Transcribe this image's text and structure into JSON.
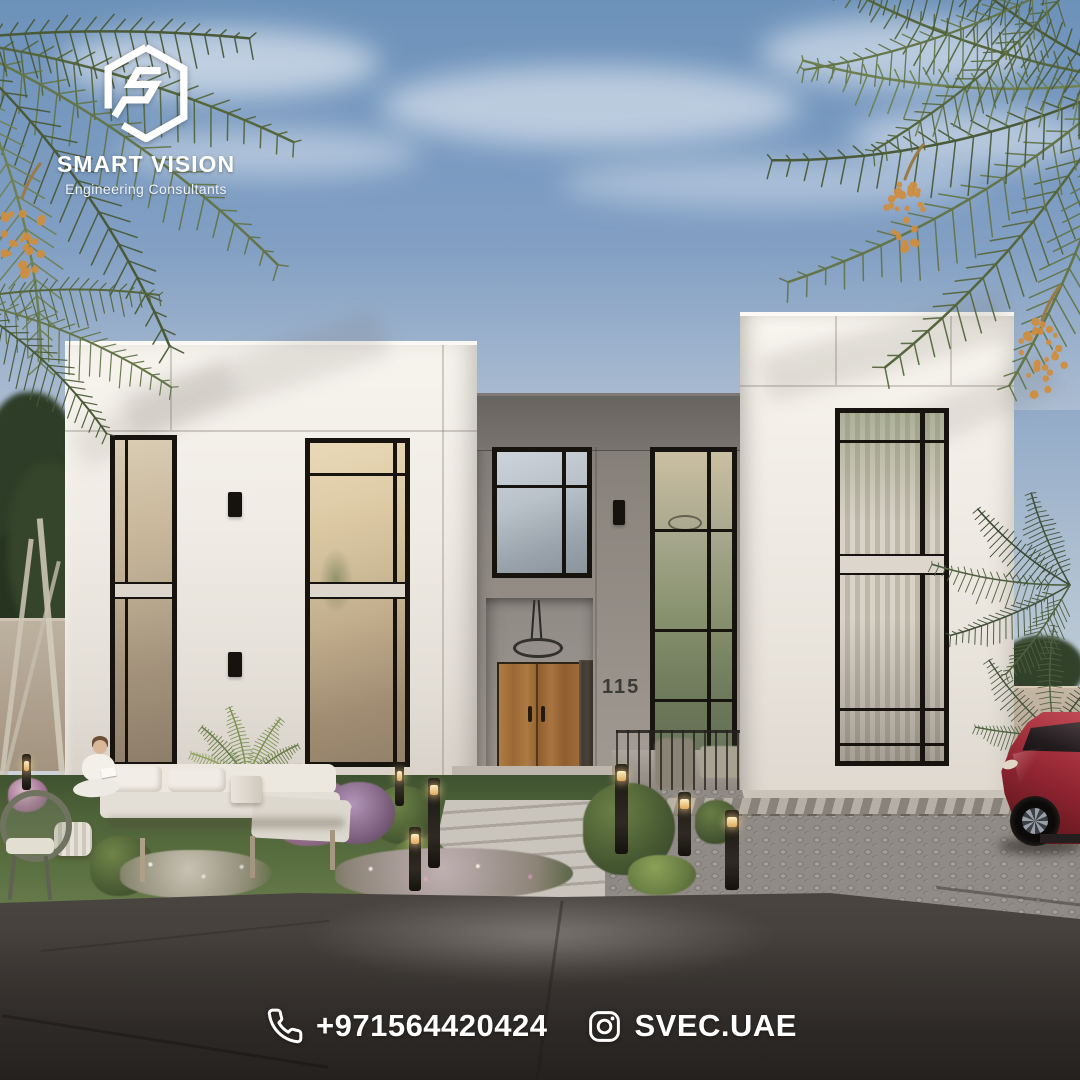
{
  "brand": {
    "name": "SMART VISION",
    "tagline": "Engineering Consultants",
    "emblem": "hexagon-s-logo"
  },
  "villa": {
    "house_number": "115"
  },
  "contact": {
    "phone": "+971564420424",
    "instagram_handle": "SVEC.UAE"
  },
  "icons": {
    "phone": "phone-icon",
    "instagram": "instagram-icon"
  },
  "palette": {
    "sky": "#7d9cc2",
    "facade_white": "#f2eee7",
    "facade_grey": "#8c8680",
    "window_frame": "#17140f",
    "door_wood": "#a8713c",
    "grass": "#4f6337",
    "paving": "#9b968f",
    "car_red": "#8e2430",
    "palm_green": "#5a6a41",
    "dates_orange": "#cf8d3e",
    "footer_text": "#ffffff"
  }
}
